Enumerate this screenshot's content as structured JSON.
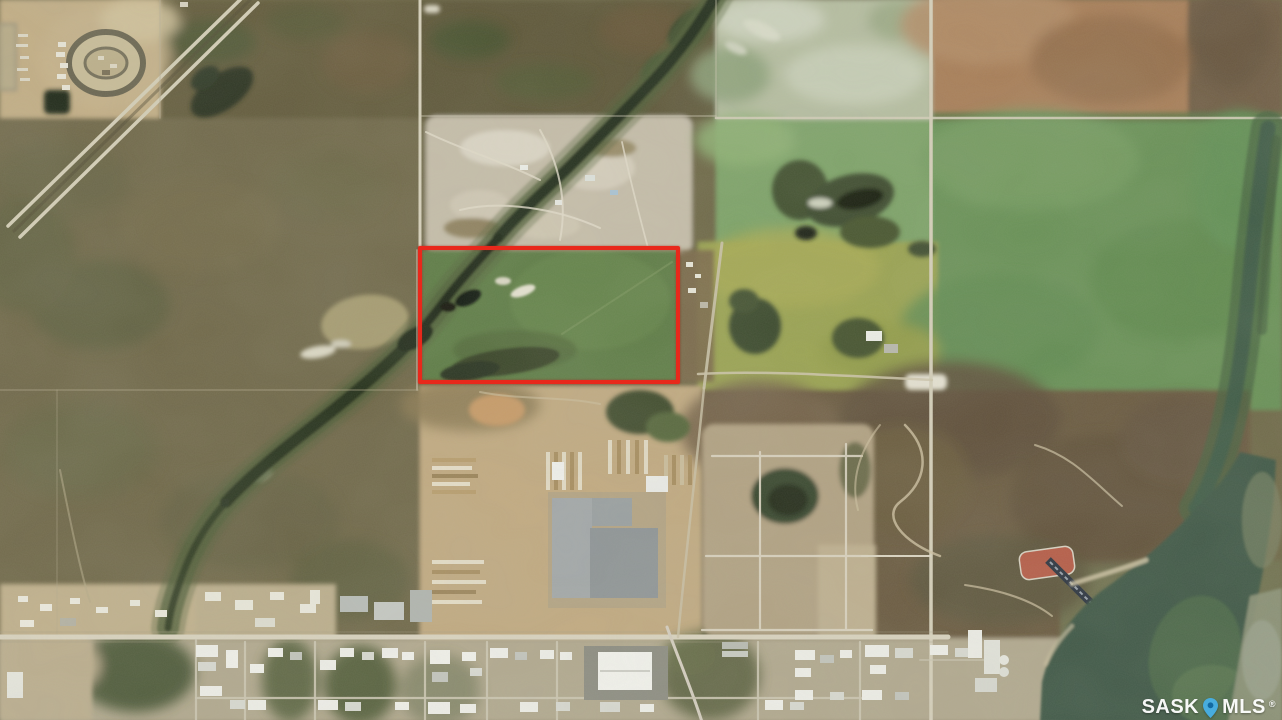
{
  "scene": {
    "type": "aerial-satellite-photo",
    "subject": "Rural land parcels with a highlighted property boundary near an industrial area and river",
    "features": [
      "racetrack-oval",
      "divided-highway",
      "creek-wetland-corridor",
      "gravel-pit",
      "pasture-fields",
      "crop-fields",
      "highlighted-parcel-boundary",
      "lumberyard-industrial-complex",
      "warehouse-subdivision",
      "ball-diamond",
      "rail-siding",
      "river"
    ]
  },
  "boundary": {
    "shape": "rectangle",
    "color": "#e8281b"
  },
  "watermark": {
    "left": "SASK",
    "right": "MLS",
    "reg": "®",
    "pin_color": "#47b0e6",
    "pin_dot_color": "#0f6aa6",
    "text_color": "#ffffff"
  }
}
